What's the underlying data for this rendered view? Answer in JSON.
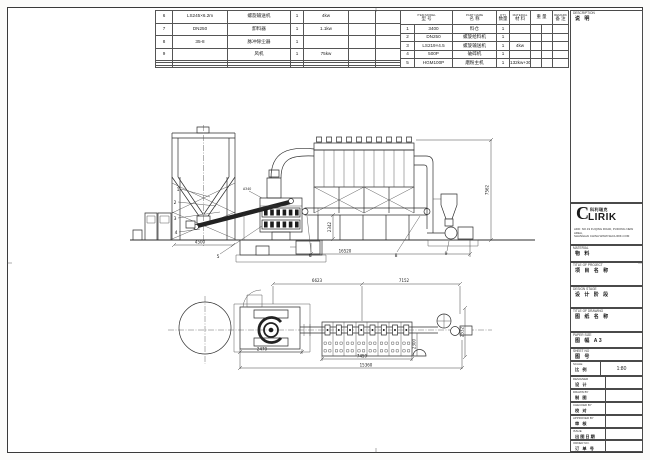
{
  "tables": {
    "left": {
      "rows": [
        {
          "no": "6",
          "model": "LS245×6.2m",
          "name": "螺旋输送机",
          "qty": "1",
          "power": "4kw"
        },
        {
          "no": "7",
          "model": "DN250",
          "name": "卸料器",
          "qty": "1",
          "power": "1.1kw"
        },
        {
          "no": "8",
          "model": "35-8",
          "name": "脉冲除尘器",
          "qty": "1",
          "power": ""
        },
        {
          "no": "9",
          "model": "",
          "name": "风机",
          "qty": "1",
          "power": "75kw"
        }
      ]
    },
    "right": {
      "header": {
        "item_model_en": "ITEM MODEL",
        "item_model_cn": "型 号",
        "name_en": "PART NAME",
        "name_cn": "名 称",
        "qty_en": "QTY",
        "qty_cn": "数量",
        "mat_en": "MATERIAL",
        "mat_cn": "材 料",
        "weight_cn": "重 量",
        "remark_en": "REMARK",
        "remark_cn": "备 注"
      },
      "rows": [
        {
          "no": "1",
          "model": "3400",
          "name": "料仓",
          "qty": "1",
          "material": "",
          "remark": ""
        },
        {
          "no": "2",
          "model": "DN250",
          "name": "螺旋给料机",
          "qty": "1",
          "material": "",
          "remark": ""
        },
        {
          "no": "3",
          "model": "LS219×4.5",
          "name": "螺旋输送机",
          "qty": "1",
          "material": "4kw",
          "remark": ""
        },
        {
          "no": "4",
          "model": "500P",
          "name": "破碎机",
          "qty": "1",
          "material": "",
          "remark": ""
        },
        {
          "no": "5",
          "model": "HGM100P",
          "name": "磨粉主机",
          "qty": "1",
          "material": "132kw+30kw",
          "remark": ""
        }
      ]
    }
  },
  "titleblock": {
    "description": {
      "en": "DESCRIPTION",
      "cn": "说 明"
    },
    "logo": {
      "c": "C",
      "rest": "LIRIK",
      "cn": "科利瑞克",
      "addr1": "ADD: NO.19 FUQING ROAD, PUDONG NEW AREA,",
      "addr2": "SHANGHAI CHINA  WWW.SHCLIRIK.COM"
    },
    "material": {
      "en": "MATERIAL",
      "cn": "物 料"
    },
    "project": {
      "en": "TITLE OF PROJECT",
      "cn": "项 目 名 称"
    },
    "stage": {
      "en": "DESIGN STAGE",
      "cn": "设 计 阶 段"
    },
    "drawing_title": {
      "en": "TITLE OF DRAWING",
      "cn": "图 纸 名 称"
    },
    "paper": {
      "en": "PAPER SIZE",
      "cn": "图 幅  A3"
    },
    "sheet": {
      "en": "SHEET NO",
      "cn": "图 号"
    },
    "scale": {
      "en": "SCALE",
      "cn": "比 例",
      "value": "1:80"
    },
    "signs": [
      {
        "en": "DESIGNER",
        "cn": "设 计"
      },
      {
        "en": "DRAWN BY",
        "cn": "制 图"
      },
      {
        "en": "CHECKED BY",
        "cn": "校 对"
      },
      {
        "en": "APPROVED BY",
        "cn": "审 核"
      },
      {
        "en": "ISSUE",
        "cn": "出图日期"
      },
      {
        "en": "ORDER NO.",
        "cn": "订 单 号"
      }
    ]
  },
  "drawing": {
    "dims": {
      "filter_height": "7562",
      "conveyor_height": "2342",
      "elev_total": "16520",
      "silo_width": "4500",
      "plan_left": "6623",
      "plan_right": "7152",
      "mill_width": "2470",
      "filter_width": "7459",
      "plan_total": "15360",
      "filter_depth": "2300",
      "right_depth": "2532",
      "inlet_label": "A340"
    },
    "callouts": {
      "c1": "1",
      "c2": "2",
      "c3": "3",
      "c4": "4",
      "c5": "5",
      "c6": "6",
      "c8": "8",
      "c9": "9"
    }
  }
}
